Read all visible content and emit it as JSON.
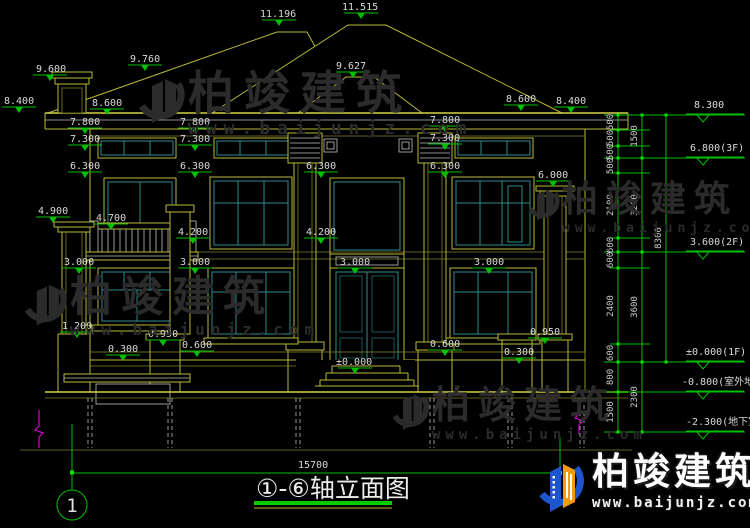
{
  "drawing": {
    "title_text": "①-⑥轴立面图",
    "axis_bubble": "1",
    "overall_width_dim": "15700",
    "marks": {
      "m1": "9.600",
      "m2": "8.400",
      "m3": "8.600",
      "m4": "9.760",
      "m5": "11.196",
      "m6": "11.515",
      "m7": "9.627",
      "m8": "8.600",
      "m9": "8.400",
      "m10": "7.800",
      "m11": "7.800",
      "m12": "7.800",
      "m13": "7.300",
      "m14": "7.300",
      "m15": "7.300",
      "m16": "6.300",
      "m17": "6.300",
      "m18": "6.300",
      "m19": "6.300",
      "m20": "6.000",
      "m21": "4.900",
      "m22": "4.700",
      "m23": "4.200",
      "m24": "4.200",
      "m25": "3.000",
      "m26": "3.000",
      "m27": "3.000",
      "m28": "3.000",
      "m29": "1.200",
      "m30": "0.950",
      "m31": "0.950",
      "m32": "0.600",
      "m33": "0.600",
      "m34": "0.300",
      "m35": "0.300",
      "m36": "±0.000"
    },
    "levels": {
      "l1": "8.300",
      "l2": "6.800(3F)",
      "l3": "3.600(2F)",
      "l4": "±0.000(1F)",
      "l5": "-0.800(室外地面)",
      "l6": "-2.300(地下室)"
    },
    "chain": {
      "c1a": "500",
      "c1b": "500",
      "c1c": "500",
      "c1d": "500",
      "c1e": "2100",
      "c1f": "600",
      "c1g": "600",
      "c1h": "2400",
      "c1i": "600",
      "c1j": "800",
      "c1k": "1500",
      "c2a": "1500",
      "c2b": "3200",
      "c2c": "3600",
      "c2d": "2300",
      "c3a": "8300"
    }
  },
  "watermark": {
    "brand": "柏竣建筑",
    "site": "www.baijunjz.com"
  },
  "logo": {
    "brand": "柏竣建筑",
    "site": "www.baijunjz.com"
  }
}
